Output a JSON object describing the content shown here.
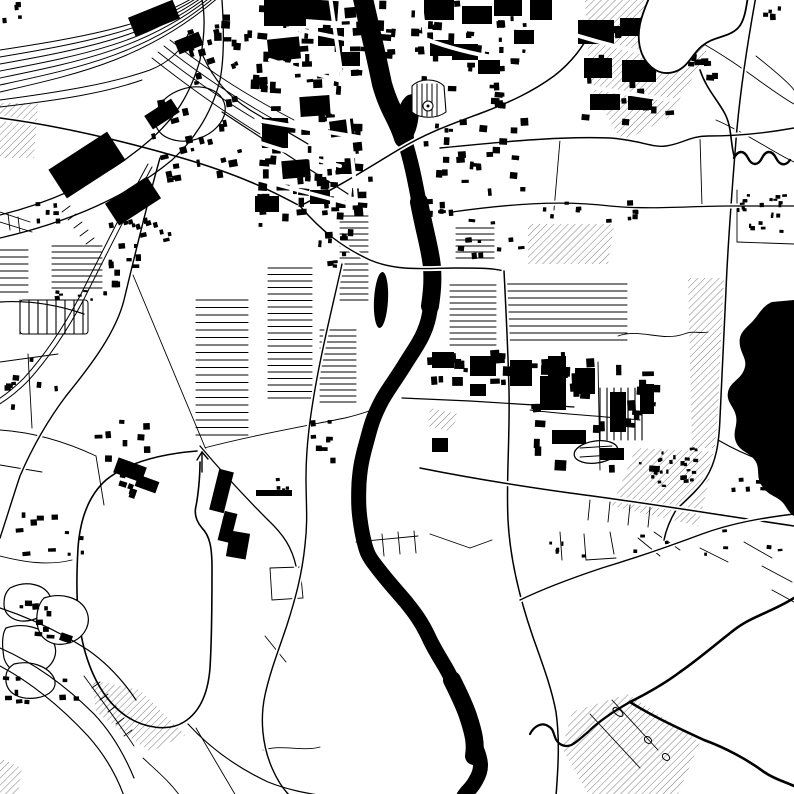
{
  "canvas": {
    "width": 794,
    "height": 794
  },
  "colors": {
    "background": "#ffffff",
    "ink": "#000000",
    "hatch": "#444444"
  },
  "map": {
    "river": {
      "base": "M362,-6 C370,30 376,55 382,84 C390,112 398,118 404,138 C412,165 414,176 419,202 C426,238 430,248 432,267 C434,288 432,300 429,316 C425,336 415,348 404,366 C390,388 386,392 380,404 C371,422 370,430 366,444 C361,462 360,470 359,483 C358,505 359,515 362,532 C366,552 368,556 376,566 C388,582 396,590 406,602 C414,612 422,622 430,640 C440,660 446,666 452,680 C458,692 462,700 466,712 C470,722 472,736 476,748 C482,762 482,770 476,780 C472,788 468,790 464,796",
      "width": 15,
      "overlays": [
        {
          "d": "M362,-6 C370,30 376,55 382,84 C390,112 398,118 404,138",
          "w": 20
        },
        {
          "d": "M419,202 C426,238 430,248 432,267 C433,282 432,292 430,306",
          "w": 18
        },
        {
          "d": "M452,680 C458,692 464,704 468,716 C474,734 476,744 474,756",
          "w": 18
        }
      ],
      "pool": [
        407,
        120,
        11,
        26,
        10
      ],
      "island": [
        381,
        300,
        7,
        28,
        3
      ]
    },
    "water": {
      "lake": "M794,300 L772,302 C762,306 758,316 752,322 C744,330 738,334 740,346 C742,356 748,360 744,370 C740,380 730,382 728,392 C726,402 734,406 736,416 C738,426 732,432 736,442 C740,452 750,452 756,462 C760,470 756,478 762,486 C768,496 778,496 784,504 C788,510 790,514 794,516 Z",
      "pond": "M650,-4 C642,14 634,34 642,54 C648,68 660,76 674,72 C688,68 692,54 702,46 C714,36 728,38 738,28 C744,22 746,10 748,-4 Z",
      "streams": [
        {
          "d": "M794,598 C772,612 752,616 734,630 C716,644 700,658 680,672 C664,684 646,694 630,702",
          "w": 2.6
        },
        {
          "d": "M630,702 C652,716 678,728 704,740 C726,748 748,760 764,772 C776,780 786,782 794,786",
          "w": 2.6
        },
        {
          "d": "M630,702 C616,710 600,720 588,732 C576,742 570,750 560,744 C552,738 556,730 548,726 C542,722 534,726 530,734",
          "w": 2.2
        },
        {
          "d": "M734,158 C738,150 744,150 748,158 C752,166 758,166 762,158 C766,150 772,150 776,158 C780,166 786,166 790,160",
          "w": 2.4
        },
        {
          "d": "M700,70 C706,88 716,98 724,112 C732,126 730,140 734,156",
          "w": 1.6
        }
      ]
    },
    "hatches": [
      "585,0 708,0 706,56 668,118 622,142 590,86",
      "688,278 726,278 720,448 692,448",
      "636,448 716,452 698,526 612,506",
      "0,103 38,103 34,158 0,158",
      "528,224 614,224 608,264 528,264",
      "92,680 140,690 185,735 150,752 96,712",
      "572,712 628,694 700,742 678,794 588,794 562,748",
      "0,758 22,768 18,794 0,794",
      "430,408 458,414 452,432 428,426"
    ],
    "rails": [
      "M0,50 C78,38 148,26 196,-4",
      "M0,57 C78,44 148,31 200,-4",
      "M0,64 C78,50 148,37 204,-4",
      "M0,71 C78,56 148,43 208,-4",
      "M0,78 C78,62 148,48 212,-4",
      "M0,85 C78,68 148,54 216,-4",
      "M0,92 C78,74 148,59 220,-4",
      "M0,100 C60,92 110,84 150,70 C170,62 182,50 188,34",
      "M0,107 C60,100 105,93 142,80",
      "M148,164 C124,208 102,252 80,296 C62,330 44,356 24,378 C14,388 4,396 -6,402",
      "M152,167 C128,211 106,255 84,299 C66,333 48,359 28,381 C18,391 8,399 -2,405"
    ],
    "roads": [
      {
        "d": "M0,118 C60,126 120,140 182,158 C240,175 270,190 300,206",
        "w": 1.5,
        "c": 1
      },
      {
        "d": "M300,206 C340,186 368,168 398,150 C428,132 452,124 484,112 C510,102 532,92 554,76 C572,62 582,48 592,30",
        "w": 1.5,
        "c": 1
      },
      {
        "d": "M300,206 C322,232 344,248 370,260 C398,272 428,268 456,268 C480,268 492,268 504,271",
        "w": 1.4,
        "c": 1
      },
      {
        "d": "M504,271 C506,310 508,350 509,390 C510,440 506,480 508,520 C510,560 520,600 534,640 C544,668 552,690 556,712 C560,740 558,770 556,796",
        "w": 1.5,
        "c": 1
      },
      {
        "d": "M756,-4 C748,40 740,90 736,140 C732,190 728,240 726,290 C724,340 722,380 720,418 C719,444 716,462 706,478 C698,490 686,500 676,510 C670,520 666,530 664,540",
        "w": 1.5,
        "c": 1
      },
      {
        "d": "M420,468 C470,478 520,486 570,493 C640,502 700,512 794,526",
        "w": 1.5,
        "c": 1
      },
      {
        "d": "M520,600 C545,588 572,578 602,568 C642,556 670,546 702,534 C732,523 762,518 794,514",
        "w": 1.4,
        "c": 1
      },
      {
        "d": "M440,148 C500,142 560,136 610,138 C640,140 652,148 666,146 C682,144 690,136 708,136 C742,136 772,132 794,128",
        "w": 1.4,
        "c": 1
      },
      {
        "d": "M452,212 C510,204 560,200 610,206 C650,210 690,206 730,206 C754,206 776,206 794,206",
        "w": 1.3,
        "c": 1
      },
      {
        "d": "M342,264 C334,300 324,340 317,378 C310,416 306,446 306,478 C306,504 308,520 305,545 C302,575 295,600 287,625 C278,652 270,672 265,695 C260,718 262,745 272,768 C278,782 284,790 290,796",
        "w": 1.4,
        "c": 1
      },
      {
        "d": "M200,446 C222,472 246,498 268,520 C284,535 292,548 296,566",
        "w": 1.3,
        "c": 1
      },
      {
        "d": "M160,158 C148,200 136,250 124,300 C116,332 92,364 66,396 C48,420 32,448 20,476 C12,500 6,520 0,538",
        "w": 1.4,
        "c": 1
      },
      {
        "d": "M0,302 C30,300 58,305 84,314",
        "w": 1.2,
        "c": 0
      },
      {
        "d": "M402,398 L470,401 L534,405 C552,406 562,406 574,407",
        "w": 1.2,
        "c": 0
      },
      {
        "d": "M718,440 C742,454 768,464 794,470",
        "w": 1.2,
        "c": 0
      },
      {
        "d": "M0,215 C60,200 110,175 150,140 C175,118 190,95 200,60 C205,35 205,15 202,0",
        "w": 1.3,
        "c": 0
      },
      {
        "d": "M0,238 C70,222 130,195 172,160 C196,138 212,112 220,80 C224,60 224,30 222,0",
        "w": 1.3,
        "c": 0
      },
      {
        "d": "M203,56 C214,80 228,96 250,110 C268,121 288,132 308,144",
        "w": 1.2,
        "c": 0
      },
      {
        "d": "M222,112 C246,128 268,142 292,158 C310,170 330,182 348,194",
        "w": 1.2,
        "c": 0
      },
      {
        "d": "M0,608 C30,618 60,632 88,650 C108,664 124,682 136,700",
        "w": 1.2,
        "c": 0
      },
      {
        "d": "M0,648 C32,662 64,684 94,714 C112,733 124,754 134,778",
        "w": 1.2,
        "c": 0
      },
      {
        "d": "M0,666 C30,682 60,706 88,736 C104,754 116,774 124,796",
        "w": 1.2,
        "c": 0
      },
      {
        "d": "M188,724 C210,748 238,768 268,782 C288,790 306,793 324,796",
        "w": 1.2,
        "c": 0
      }
    ],
    "thin": [
      "M133,275 L207,452",
      "M204,448 C250,436 300,427 345,418 C362,414 374,410 384,404",
      "M618,336 C640,328 662,342 684,334 C694,330 700,334 708,332",
      "M356,542 L418,536",
      "M366,536 L368,556",
      "M382,534 L384,556",
      "M398,532 L400,554",
      "M414,531 L416,553",
      "M430,534 L470,548",
      "M470,548 L492,540",
      "M530,410 C560,414 600,416 640,420",
      "M598,362 L600,470",
      "M560,532 L562,560",
      "M584,534 L586,560 L616,558",
      "M610,532 L614,554",
      "M638,538 L660,556",
      "M654,532 L680,550",
      "M700,548 L728,562",
      "M744,542 L772,558",
      "M762,566 L792,582",
      "M772,590 L794,602",
      "M737,190 L737,242",
      "M737,242 L794,244",
      "M700,42 C740,64 772,92 794,104",
      "M716,120 C748,134 776,154 794,162",
      "M756,56 C776,72 790,84 794,90",
      "M0,362 L58,354",
      "M28,354 L32,428",
      "M0,430 C30,432 62,440 96,456",
      "M96,456 L104,505",
      "M0,465 L42,472",
      "M0,556 C24,562 48,566 72,560",
      "M84,676 C100,698 118,722 134,746",
      "M92,688 L100,682",
      "M100,700 L108,694",
      "M108,712 L116,706",
      "M116,724 L124,718",
      "M124,736 L132,730",
      "M143,758 C158,772 170,782 180,796",
      "M196,728 L236,796",
      "M270,568 L300,567 L303,598 L272,600 L270,568",
      "M265,636 L286,662",
      "M263,750 C282,744 302,752 320,747",
      "M590,500 L588,520",
      "M610,502 L608,522",
      "M630,505 L628,525",
      "M650,507 L648,527",
      "M590,714 L640,768",
      "M612,700 L658,750",
      "M560,140 L554,210",
      "M700,138 L702,206",
      "M0,212 L30,222",
      "M0,222 L32,232",
      "M8,214 L10,230",
      "M18,217 L20,233",
      "M62,212 L70,206",
      "M68,220 L76,214",
      "M74,228 L82,222",
      "M80,236 L88,230",
      "M86,244 L94,238",
      "M158,52 C196,82 232,106 270,128",
      "M164,46 C204,78 242,102 282,124",
      "M170,40 C212,74 252,98 294,120",
      "M152,58 C190,88 224,112 260,134",
      "M580,448 L612,446",
      "M580,457 L612,455"
    ],
    "white_streets": [
      "M270,60 C300,70 330,78 360,86",
      "M256,120 C290,126 330,132 364,138",
      "M428,40 C450,48 474,54 498,58",
      "M560,30 C590,40 620,48 650,54",
      "M588,86 C614,92 644,96 672,100",
      "M300,30 C320,34 340,38 360,42",
      "M252,140 C280,150 310,158 340,166",
      "M260,180 C290,188 320,196 350,204",
      "M330,-4 C336,40 342,80 348,120 C352,150 354,175 356,200",
      "M420,-4 C424,30 428,60 430,92"
    ],
    "strips": [
      [
        450,
        285,
        46,
        62,
        "h",
        6,
        0
      ],
      [
        505,
        284,
        122,
        58,
        "h",
        7,
        0
      ],
      [
        268,
        268,
        44,
        134,
        "h",
        6.5,
        0
      ],
      [
        340,
        216,
        28,
        88,
        "h",
        6,
        0
      ],
      [
        320,
        330,
        36,
        74,
        "h",
        6,
        0
      ],
      [
        196,
        300,
        52,
        138,
        "h",
        7.5,
        0
      ],
      [
        52,
        246,
        50,
        44,
        "h",
        6,
        0
      ],
      [
        0,
        250,
        28,
        48,
        "h",
        7,
        0
      ],
      [
        456,
        228,
        38,
        34,
        "h",
        6,
        0
      ],
      [
        600,
        388,
        44,
        52,
        "v",
        7,
        0
      ],
      [
        20,
        300,
        68,
        34,
        "v",
        9,
        1
      ]
    ],
    "big": [
      [
        52,
        148,
        70,
        34,
        -33
      ],
      [
        108,
        188,
        50,
        26,
        -33
      ],
      [
        146,
        106,
        32,
        16,
        -33
      ],
      [
        130,
        8,
        48,
        20,
        -22
      ],
      [
        176,
        36,
        26,
        14,
        -22
      ],
      [
        264,
        0,
        42,
        26,
        0
      ],
      [
        302,
        0,
        36,
        20,
        4
      ],
      [
        268,
        38,
        32,
        22,
        -6
      ],
      [
        318,
        28,
        26,
        18,
        0
      ],
      [
        338,
        52,
        22,
        14,
        0
      ],
      [
        300,
        96,
        30,
        20,
        -4
      ],
      [
        262,
        118,
        26,
        30,
        0
      ],
      [
        330,
        120,
        24,
        16,
        -8
      ],
      [
        282,
        160,
        28,
        18,
        -5
      ],
      [
        255,
        196,
        24,
        16,
        0
      ],
      [
        310,
        190,
        20,
        14,
        0
      ],
      [
        336,
        162,
        18,
        12,
        0
      ],
      [
        424,
        0,
        30,
        20,
        0
      ],
      [
        462,
        6,
        30,
        18,
        0
      ],
      [
        430,
        40,
        24,
        16,
        0
      ],
      [
        494,
        0,
        28,
        16,
        0
      ],
      [
        514,
        30,
        20,
        14,
        0
      ],
      [
        452,
        44,
        26,
        16,
        0
      ],
      [
        478,
        60,
        22,
        14,
        0
      ],
      [
        578,
        20,
        36,
        24,
        0
      ],
      [
        620,
        18,
        32,
        18,
        0
      ],
      [
        658,
        26,
        18,
        14,
        0
      ],
      [
        584,
        58,
        28,
        20,
        0
      ],
      [
        622,
        60,
        34,
        22,
        0
      ],
      [
        590,
        94,
        30,
        16,
        0
      ],
      [
        628,
        96,
        24,
        14,
        0
      ],
      [
        660,
        58,
        16,
        12,
        0
      ],
      [
        530,
        0,
        22,
        20,
        0
      ],
      [
        214,
        470,
        15,
        42,
        14
      ],
      [
        221,
        512,
        13,
        30,
        14
      ],
      [
        228,
        532,
        20,
        26,
        10
      ],
      [
        256,
        490,
        36,
        6,
        0
      ],
      [
        770,
        412,
        24,
        24,
        0
      ],
      [
        115,
        462,
        30,
        16,
        20
      ],
      [
        136,
        478,
        22,
        12,
        20
      ],
      [
        540,
        376,
        26,
        34,
        0
      ],
      [
        575,
        368,
        20,
        26,
        0
      ],
      [
        610,
        392,
        16,
        40,
        0
      ],
      [
        640,
        384,
        14,
        30,
        0
      ],
      [
        552,
        430,
        34,
        14,
        0
      ],
      [
        600,
        448,
        24,
        12,
        0
      ],
      [
        432,
        352,
        22,
        16,
        0
      ],
      [
        470,
        356,
        26,
        20,
        0
      ],
      [
        510,
        360,
        22,
        26,
        0
      ],
      [
        548,
        356,
        18,
        22,
        0
      ],
      [
        470,
        384,
        16,
        12,
        0
      ],
      [
        432,
        438,
        16,
        14,
        0
      ],
      [
        60,
        634,
        12,
        8,
        20
      ]
    ],
    "clusters": [
      [
        248,
        0,
        148,
        96,
        60,
        3,
        12,
        0
      ],
      [
        246,
        98,
        128,
        130,
        62,
        3,
        11,
        0
      ],
      [
        410,
        0,
        118,
        72,
        40,
        3,
        9,
        0
      ],
      [
        418,
        76,
        112,
        152,
        48,
        3,
        9,
        0
      ],
      [
        576,
        18,
        102,
        112,
        20,
        4,
        10,
        0
      ],
      [
        678,
        54,
        40,
        48,
        7,
        4,
        8,
        0
      ],
      [
        150,
        96,
        100,
        88,
        26,
        3,
        9,
        -10
      ],
      [
        214,
        0,
        42,
        58,
        9,
        4,
        9,
        0
      ],
      [
        756,
        0,
        36,
        24,
        5,
        3,
        6,
        0
      ],
      [
        455,
        236,
        72,
        28,
        9,
        3,
        7,
        0
      ],
      [
        538,
        198,
        106,
        26,
        12,
        3,
        6,
        0
      ],
      [
        414,
        348,
        180,
        54,
        24,
        4,
        11,
        0
      ],
      [
        528,
        358,
        134,
        118,
        30,
        4,
        12,
        0
      ],
      [
        638,
        446,
        62,
        44,
        26,
        2,
        5,
        0
      ],
      [
        736,
        194,
        56,
        40,
        22,
        2,
        5,
        0
      ],
      [
        174,
        28,
        72,
        62,
        14,
        3,
        8,
        -15
      ],
      [
        0,
        356,
        58,
        56,
        8,
        3,
        7,
        0
      ],
      [
        92,
        418,
        62,
        50,
        9,
        3,
        8,
        0
      ],
      [
        0,
        498,
        84,
        58,
        11,
        3,
        8,
        0
      ],
      [
        112,
        458,
        64,
        42,
        8,
        4,
        9,
        18
      ],
      [
        0,
        596,
        56,
        44,
        9,
        3,
        8,
        0
      ],
      [
        0,
        670,
        96,
        36,
        10,
        3,
        7,
        0
      ],
      [
        545,
        528,
        130,
        36,
        8,
        2,
        5,
        0
      ],
      [
        700,
        528,
        90,
        28,
        5,
        2,
        5,
        0
      ],
      [
        726,
        470,
        62,
        22,
        8,
        3,
        6,
        0
      ],
      [
        0,
        0,
        32,
        28,
        4,
        3,
        7,
        0
      ],
      [
        300,
        228,
        56,
        40,
        10,
        3,
        8,
        0
      ],
      [
        310,
        420,
        34,
        56,
        8,
        3,
        7,
        0
      ],
      [
        108,
        204,
        68,
        40,
        14,
        3,
        7,
        -15
      ],
      [
        100,
        240,
        42,
        48,
        10,
        3,
        8,
        0
      ],
      [
        52,
        288,
        56,
        14,
        8,
        2,
        5,
        0
      ],
      [
        30,
        198,
        34,
        26,
        6,
        3,
        6,
        0
      ],
      [
        274,
        472,
        28,
        22,
        4,
        3,
        6,
        0
      ]
    ],
    "outlines": {
      "racetrack": "M197,451 C160,454 128,462 106,480 C88,496 80,520 78,548 C76,584 76,616 84,648 C92,678 106,702 126,716 C144,728 168,732 184,722 C200,712 208,694 210,668 C212,636 212,600 212,568 C212,548 210,536 202,528 C196,521 194,514 196,506 C198,496 200,478 200,462",
      "golf": [
        "M10,588 C26,580 44,584 50,596 C54,606 46,616 32,620 C16,624 4,616 4,604 C4,596 6,592 10,588 Z",
        "M6,628 C24,622 44,628 52,640 C60,652 54,666 40,672 C24,678 8,672 4,658 C2,646 2,634 6,628 Z",
        "M44,598 C62,592 80,598 86,610 C92,622 86,636 72,642 C56,648 42,642 38,628 C35,616 38,604 44,598 Z",
        "M14,664 C30,660 48,666 54,678 C58,688 50,696 36,698 C20,700 8,694 6,682 C5,672 8,668 14,664 Z"
      ],
      "roundabout": [
        190,
        114,
        36,
        26,
        -18
      ],
      "stadium": [
        596,
        452,
        22,
        11,
        -8
      ],
      "ovals": [
        [
          618,
          712,
          6,
          3,
          40
        ],
        [
          648,
          740,
          4,
          3,
          40
        ],
        [
          666,
          757,
          4,
          3,
          40
        ]
      ],
      "amphitheater": {
        "base": "M412,86 C420,78 436,78 444,86 L446,112 C437,119 420,119 412,112 Z",
        "ribs": [
          417,
          422,
          427,
          432,
          437
        ],
        "rib_y": [
          84,
          116
        ],
        "circle": [
          428,
          106,
          5
        ]
      },
      "arrow": [
        "M202,472 L202,452",
        "M202,452 L197,460",
        "M202,452 L208,459"
      ]
    }
  }
}
